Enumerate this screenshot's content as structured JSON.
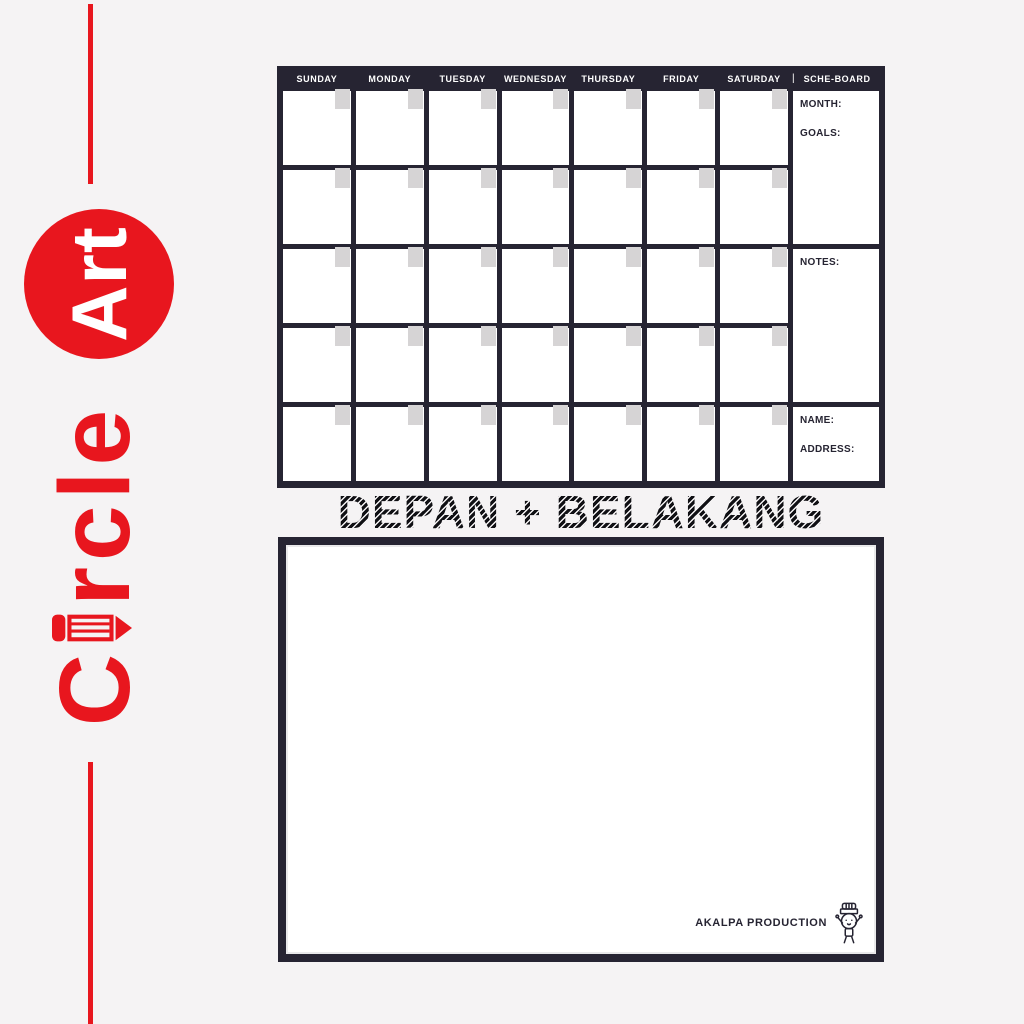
{
  "colors": {
    "background": "#f5f3f4",
    "board_dark": "#262432",
    "tab_gray": "#d6d4d5",
    "accent_red": "#e8161e",
    "text_light": "#ffffff"
  },
  "icons": {
    "pencil": "pencil glyph forming the letter i",
    "mascot": "small character with striped cap and raised arms"
  },
  "brand": {
    "word_start": "C",
    "word_end": "rcle",
    "circle_word": "Art"
  },
  "calendar_board": {
    "rows": 5,
    "columns": 7,
    "days": [
      "SUNDAY",
      "MONDAY",
      "TUESDAY",
      "WEDNESDAY",
      "THURSDAY",
      "FRIDAY",
      "SATURDAY"
    ],
    "separator": "|",
    "board_label": "SCHE-BOARD",
    "sidebar": {
      "month_label": "MONTH:",
      "goals_label": "GOALS:",
      "notes_label": "NOTES:",
      "name_label": "NAME:",
      "address_label": "ADDRESS:"
    }
  },
  "caption": {
    "text": "DEPAN + BELAKANG"
  },
  "whiteboard": {
    "credit": "AKALPA PRODUCTION"
  }
}
